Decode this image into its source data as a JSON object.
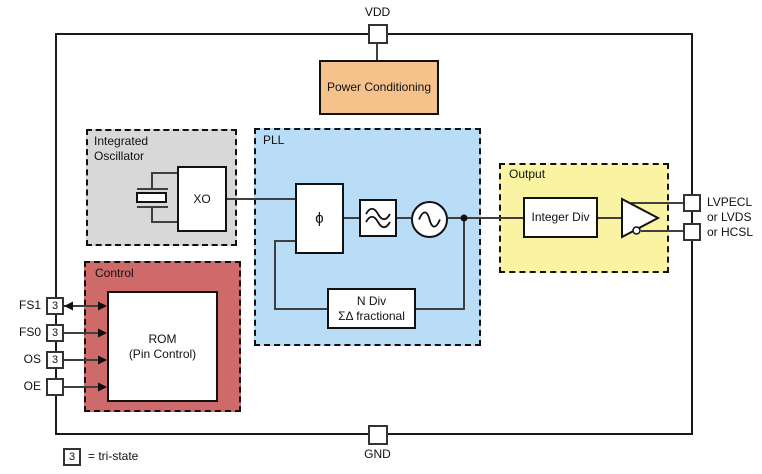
{
  "diagram": {
    "pins": {
      "vdd_label": "VDD",
      "gnd_label": "GND",
      "left_pins": [
        {
          "label": "FS1",
          "tristate": "3"
        },
        {
          "label": "FS0",
          "tristate": "3"
        },
        {
          "label": "OS",
          "tristate": "3"
        },
        {
          "label": "OE",
          "tristate": ""
        }
      ],
      "output_labels": [
        "LVPECL",
        "or LVDS",
        "or HCSL"
      ]
    },
    "blocks": {
      "power_conditioning": {
        "label": "Power Conditioning",
        "fill": "#F6C28C"
      },
      "integrated_oscillator": {
        "title": [
          "Integrated",
          "Oscillator"
        ],
        "xo_label": "XO",
        "fill": "#D8D8D8"
      },
      "pll": {
        "title": "PLL",
        "phase_symbol": "ϕ",
        "n_div": [
          "N Div",
          "ΣΔ fractional"
        ],
        "fill": "#B9DCF7"
      },
      "output": {
        "title": "Output",
        "integer_div_label": "Integer Div",
        "fill": "#F9F3A2"
      },
      "control": {
        "title": "Control",
        "rom": [
          "ROM",
          "(Pin Control)"
        ],
        "fill": "#CE6A6A"
      }
    },
    "legend": {
      "symbol": "3",
      "text": "= tri-state"
    },
    "colors": {
      "wire": "#3F3F3F",
      "border": "#111111"
    }
  }
}
